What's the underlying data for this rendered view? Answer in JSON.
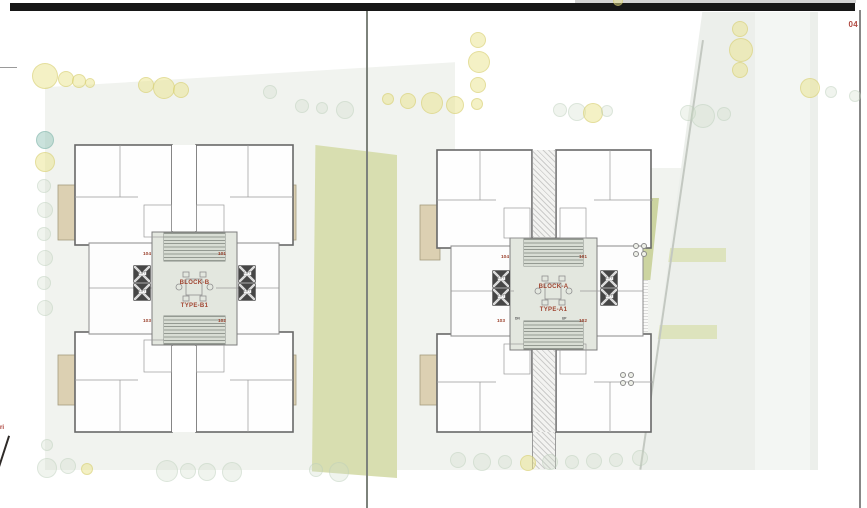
{
  "page": {
    "number": "04",
    "edge_text": "ri"
  },
  "blocks": [
    {
      "name": "BLOCK-B",
      "type": "TYPE-B1",
      "units": [
        "104",
        "101",
        "103",
        "102"
      ],
      "lift": "LIFT"
    },
    {
      "name": "BLOCK-A",
      "type": "TYPE-A1",
      "units": [
        "104",
        "101",
        "103",
        "102"
      ],
      "lift": "LIFT",
      "down": "DN",
      "up": "UP"
    }
  ],
  "colors": {
    "accent_red": "#a04531",
    "black_bar": "#171717",
    "site": "#f1f3ef",
    "lawn": "#d8deb0",
    "olive_pocket": "#ccd4a0",
    "beige_terrace": "#dcd0b2",
    "core_gray": "#e3e7df"
  }
}
